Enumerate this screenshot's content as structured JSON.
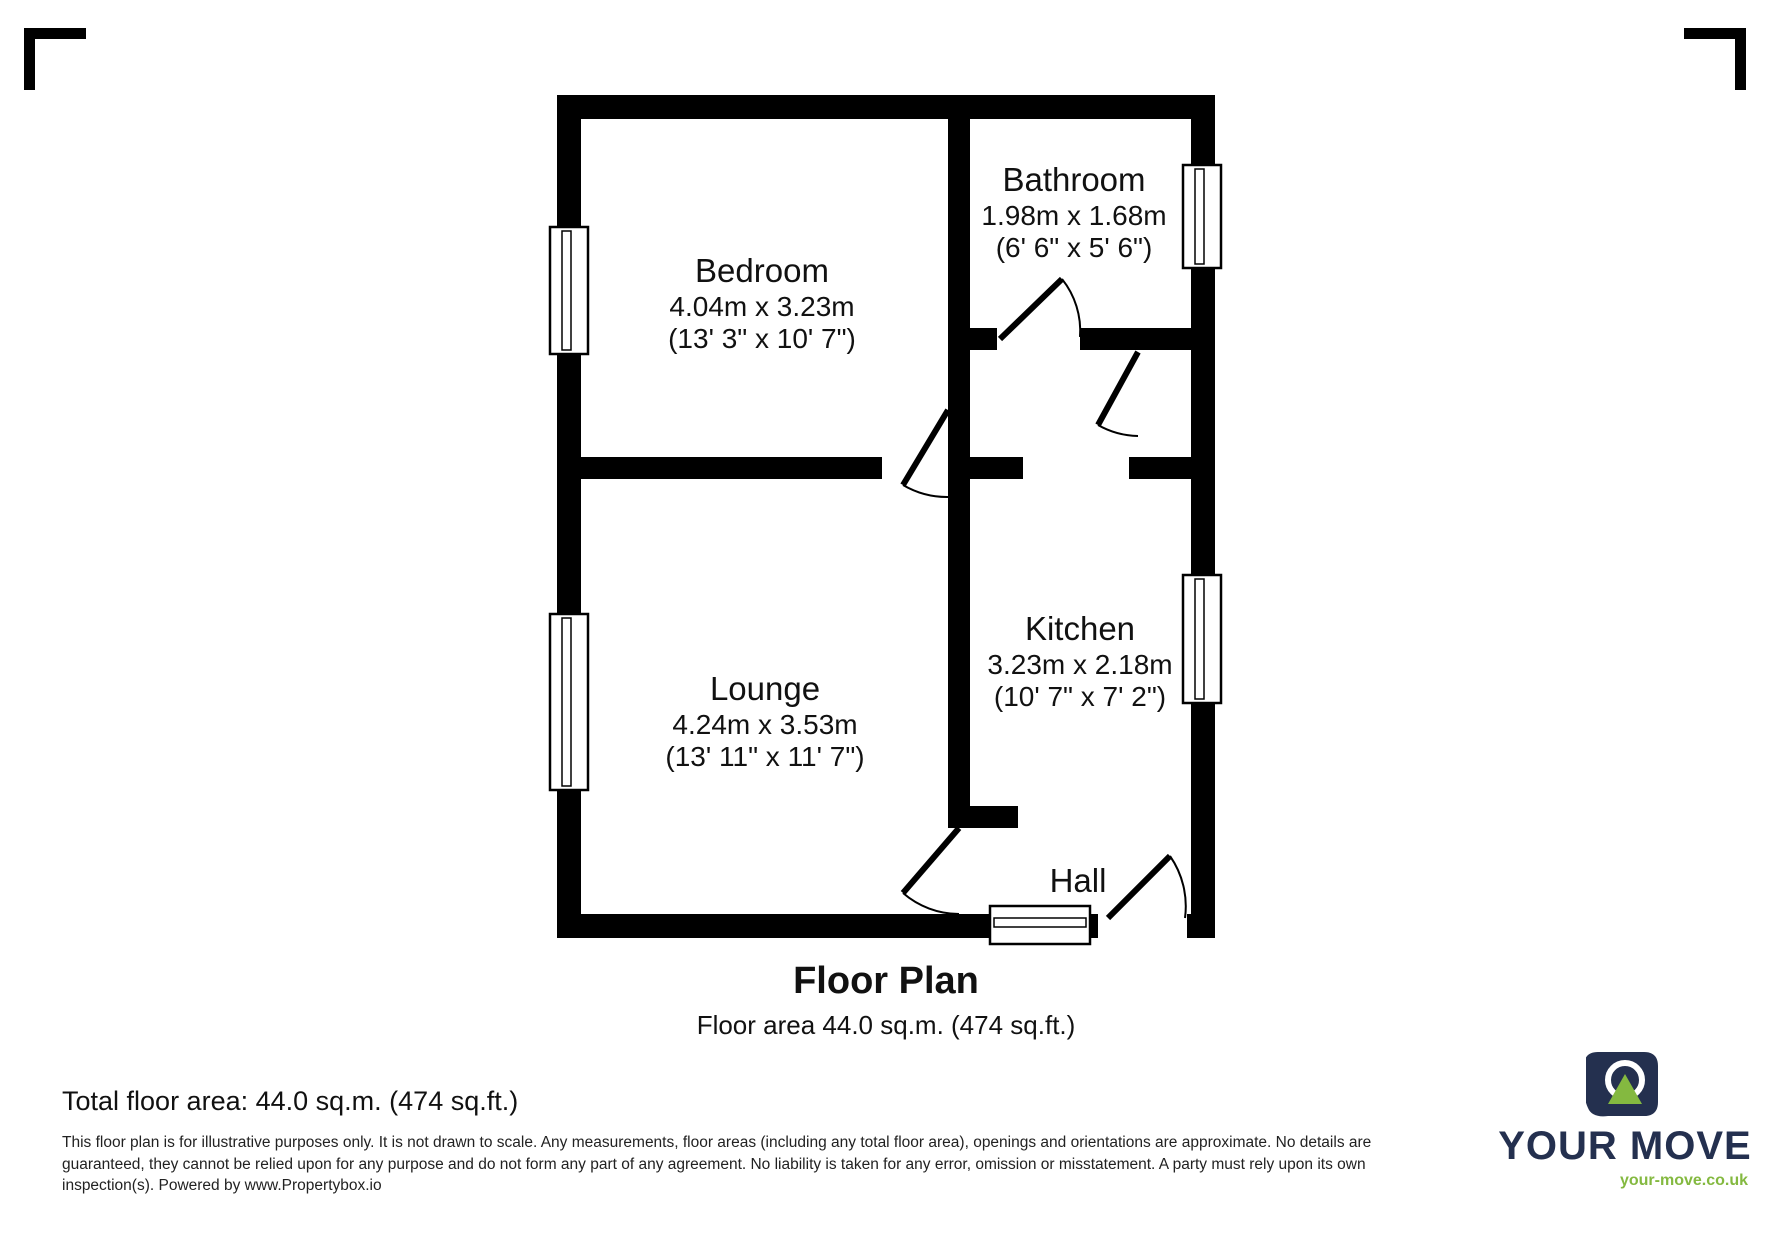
{
  "plan": {
    "title": "Floor Plan",
    "subtitle": "Floor area 44.0 sq.m. (474 sq.ft.)",
    "rooms": {
      "bedroom": {
        "name": "Bedroom",
        "metric": "4.04m x 3.23m",
        "imperial": "(13' 3\" x 10' 7\")"
      },
      "bathroom": {
        "name": "Bathroom",
        "metric": "1.98m x 1.68m",
        "imperial": "(6' 6\" x 5' 6\")"
      },
      "kitchen": {
        "name": "Kitchen",
        "metric": "3.23m x 2.18m",
        "imperial": "(10' 7\" x 7' 2\")"
      },
      "lounge": {
        "name": "Lounge",
        "metric": "4.24m x 3.53m",
        "imperial": "(13' 11\" x 11' 7\")"
      },
      "hall": {
        "name": "Hall"
      }
    }
  },
  "footer": {
    "total_area": "Total floor area: 44.0 sq.m. (474 sq.ft.)",
    "disclaimer_line1": "This floor plan is for illustrative purposes only. It is not drawn to scale. Any measurements, floor areas (including any total floor area), openings and orientations are approximate. No details are",
    "disclaimer_line2": "guaranteed, they cannot be relied upon for any purpose and do not form any part of any agreement. No liability is taken for any error, omission or misstatement. A party must rely upon its own",
    "disclaimer_line3": "inspection(s). Powered by www.Propertybox.io"
  },
  "brand": {
    "name": "YOUR MOVE",
    "url": "your-move.co.uk",
    "navy": "#24304f",
    "green": "#84b940",
    "wall_color": "#000000"
  }
}
